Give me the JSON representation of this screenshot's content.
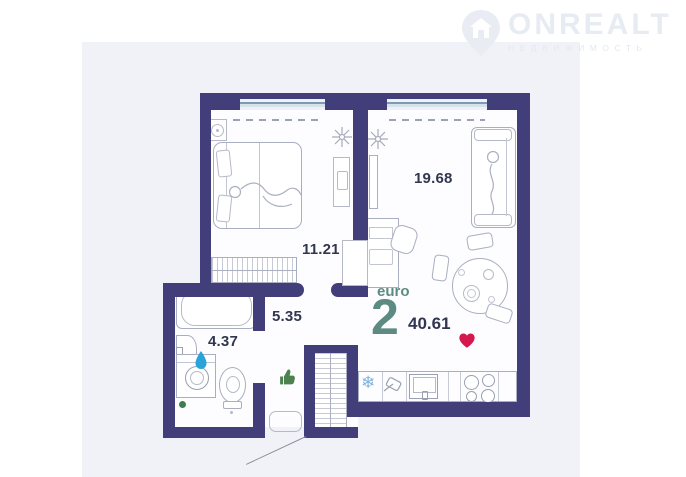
{
  "logo": {
    "brand": "ONREALT",
    "subtitle": "НЕДВИЖИМОСТЬ"
  },
  "plan": {
    "living_area": "19.68",
    "bedroom_area": "11.21",
    "hallway_area": "5.35",
    "bathroom_area": "4.37"
  },
  "summary": {
    "layout_type": "euro",
    "room_count": "2",
    "total_area": "40.61"
  },
  "icons": {
    "heart_icon_color": "#d6174d",
    "thumb_up_icon_color": "#4e8150",
    "water_drop_icon_color": "#29a3d8",
    "snowflake_glyph": "❄",
    "snowflake_icon_color": "#7fb2d9",
    "green_dot_color": "#3f7d4e"
  },
  "colors": {
    "wall": "#413e7a",
    "card_background": "#f1f2f7",
    "accent_teal": "#5d8b83",
    "label_navy": "#31374f"
  }
}
